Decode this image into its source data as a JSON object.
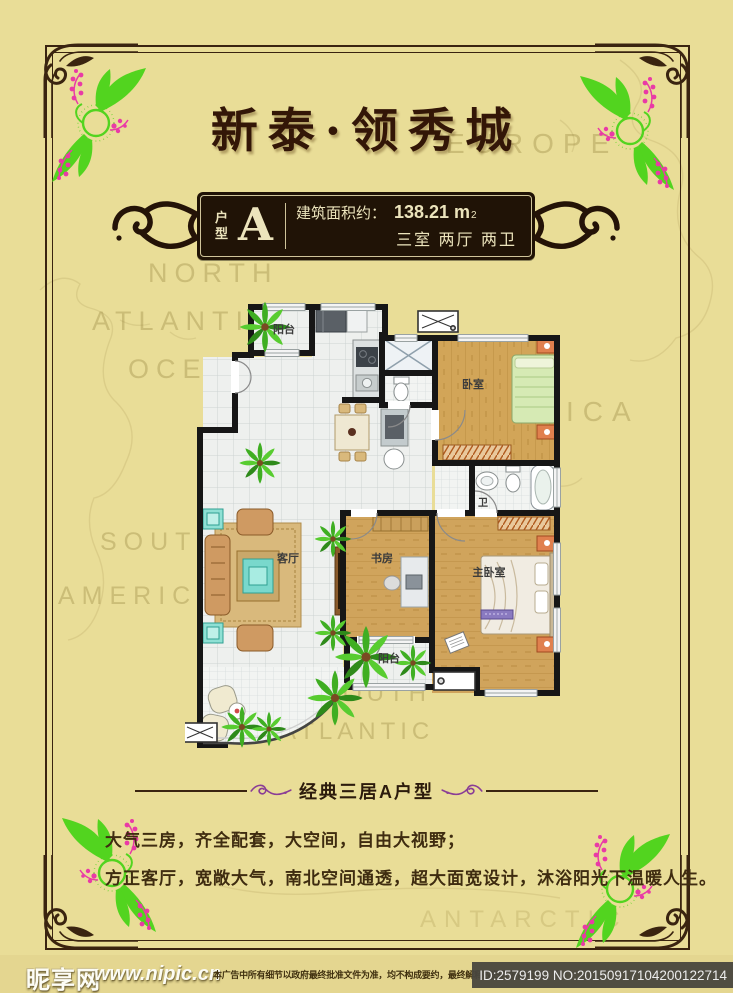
{
  "title": "新泰·领秀城",
  "badge": {
    "unit_type_vertical": [
      "户",
      "型"
    ],
    "unit_letter": "A",
    "area_label": "建筑面积约：",
    "area_value": "138.21 m",
    "area_superscript": "2",
    "layout_summary": "三室 两厅 两卫"
  },
  "floor_plan": {
    "rooms": [
      {
        "id": "balcony-top",
        "label": "阳台"
      },
      {
        "id": "bedroom",
        "label": "卧室"
      },
      {
        "id": "bathroom",
        "label": "卫"
      },
      {
        "id": "living-room",
        "label": "客厅"
      },
      {
        "id": "study",
        "label": "书房"
      },
      {
        "id": "master-bedroom",
        "label": "主卧室"
      },
      {
        "id": "balcony-bottom",
        "label": "阳台"
      }
    ]
  },
  "divider_label": "经典三居A户型",
  "description_lines": [
    "大气三房，齐全配套，大空间，自由大视野；",
    "方正客厅，宽敞大气，南北空间通透，超大面宽设计，沐浴阳光下温暖人生。"
  ],
  "footer": {
    "site_name": "昵享网",
    "site_url": "www.nipic.cn",
    "disclaimer": "本广告中所有细节以政府最终批准文件为准，均不构成要约，最终解释权归开发商所有",
    "image_id": "ID:2579199 NO:20150917104200122714"
  },
  "map_labels": [
    "NORTH",
    "ATLANTIC",
    "OCEAN",
    "EUROPE",
    "AFRICA",
    "SOUTH",
    "AMERICA",
    "SOUTH",
    "ATLANTIC",
    "ANTARCTIC"
  ],
  "colors": {
    "background": "#e9dd97",
    "frame_brown": "#3a2410",
    "title_text": "#331607",
    "badge_background": "#201306",
    "badge_text": "#ece4bc",
    "divider_swirl_purple": "#8a3d96",
    "floral_green": "#52d41f",
    "floral_pink": "#e93aa6",
    "plan_wall": "#161616",
    "plan_wood": "#d2a558",
    "plan_tile": "#eef0ee",
    "footer_id_background": "#48463e"
  }
}
